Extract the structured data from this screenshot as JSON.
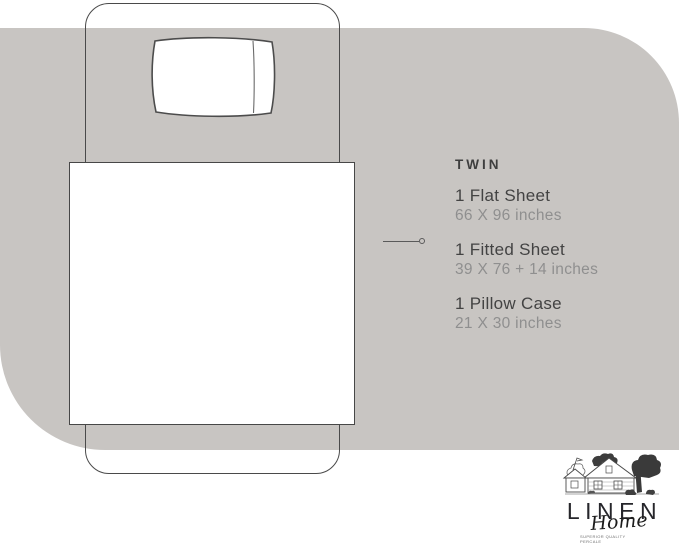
{
  "product": {
    "size_label": "TWIN",
    "items": [
      {
        "name": "1 Flat Sheet",
        "dimensions": "66 X 96 inches"
      },
      {
        "name": "1 Fitted Sheet",
        "dimensions": "39 X 76 + 14 inches"
      },
      {
        "name": "1 Pillow Case",
        "dimensions": "21 X 30 inches"
      }
    ]
  },
  "logo": {
    "brand": "LINEN",
    "script": "Home",
    "tagline_line1": "SUPERIOR QUALITY",
    "tagline_line2": "PERCALE"
  },
  "colors": {
    "background": "#ffffff",
    "panel": "#c8c5c2",
    "outline": "#4a4a4a",
    "label_text": "#3e3e3e",
    "dimension_text": "#8f8f8f",
    "logo_text": "#26262b"
  }
}
